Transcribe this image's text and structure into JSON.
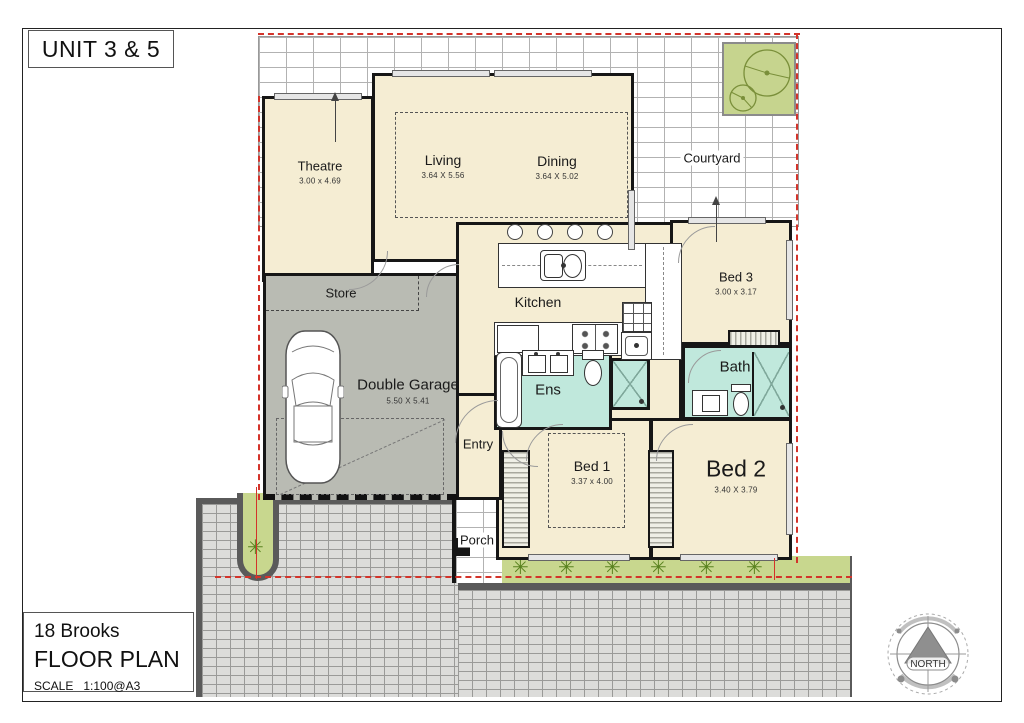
{
  "page": {
    "unit_title": "UNIT 3 & 5",
    "address": "18 Brooks",
    "doc_title": "FLOOR PLAN",
    "scale_label": "SCALE   1:100@A3"
  },
  "north": {
    "label": "NORTH"
  },
  "icons": {
    "plant": "✳"
  },
  "rooms": {
    "theatre": {
      "name": "Theatre",
      "dim": "3.00 x 4.69"
    },
    "living": {
      "name": "Living",
      "dim": "3.64 X 5.56"
    },
    "dining": {
      "name": "Dining",
      "dim": "3.64 X 5.02"
    },
    "courtyard": {
      "name": "Courtyard",
      "dim": ""
    },
    "bed3": {
      "name": "Bed 3",
      "dim": "3.00 x 3.17"
    },
    "store": {
      "name": "Store",
      "dim": ""
    },
    "garage": {
      "name": "Double Garage",
      "dim": "5.50 X 5.41"
    },
    "kitchen": {
      "name": "Kitchen",
      "dim": ""
    },
    "ens": {
      "name": "Ens",
      "dim": ""
    },
    "bath": {
      "name": "Bath",
      "dim": ""
    },
    "entry": {
      "name": "Entry",
      "dim": ""
    },
    "bed1": {
      "name": "Bed 1",
      "dim": "3.37 x 4.00"
    },
    "bed2": {
      "name": "Bed 2",
      "dim": "3.40 X 3.79"
    },
    "porch": {
      "name": "Porch",
      "dim": ""
    }
  },
  "colors": {
    "room_fill": "#f5edd3",
    "garage_fill": "#b9bbb3",
    "wet_area_fill": "#c0e8dc",
    "garden_green": "#c8d78e",
    "boundary_red": "#d3332a",
    "wall": "#161616",
    "paving_gray": "#dcdcda"
  }
}
